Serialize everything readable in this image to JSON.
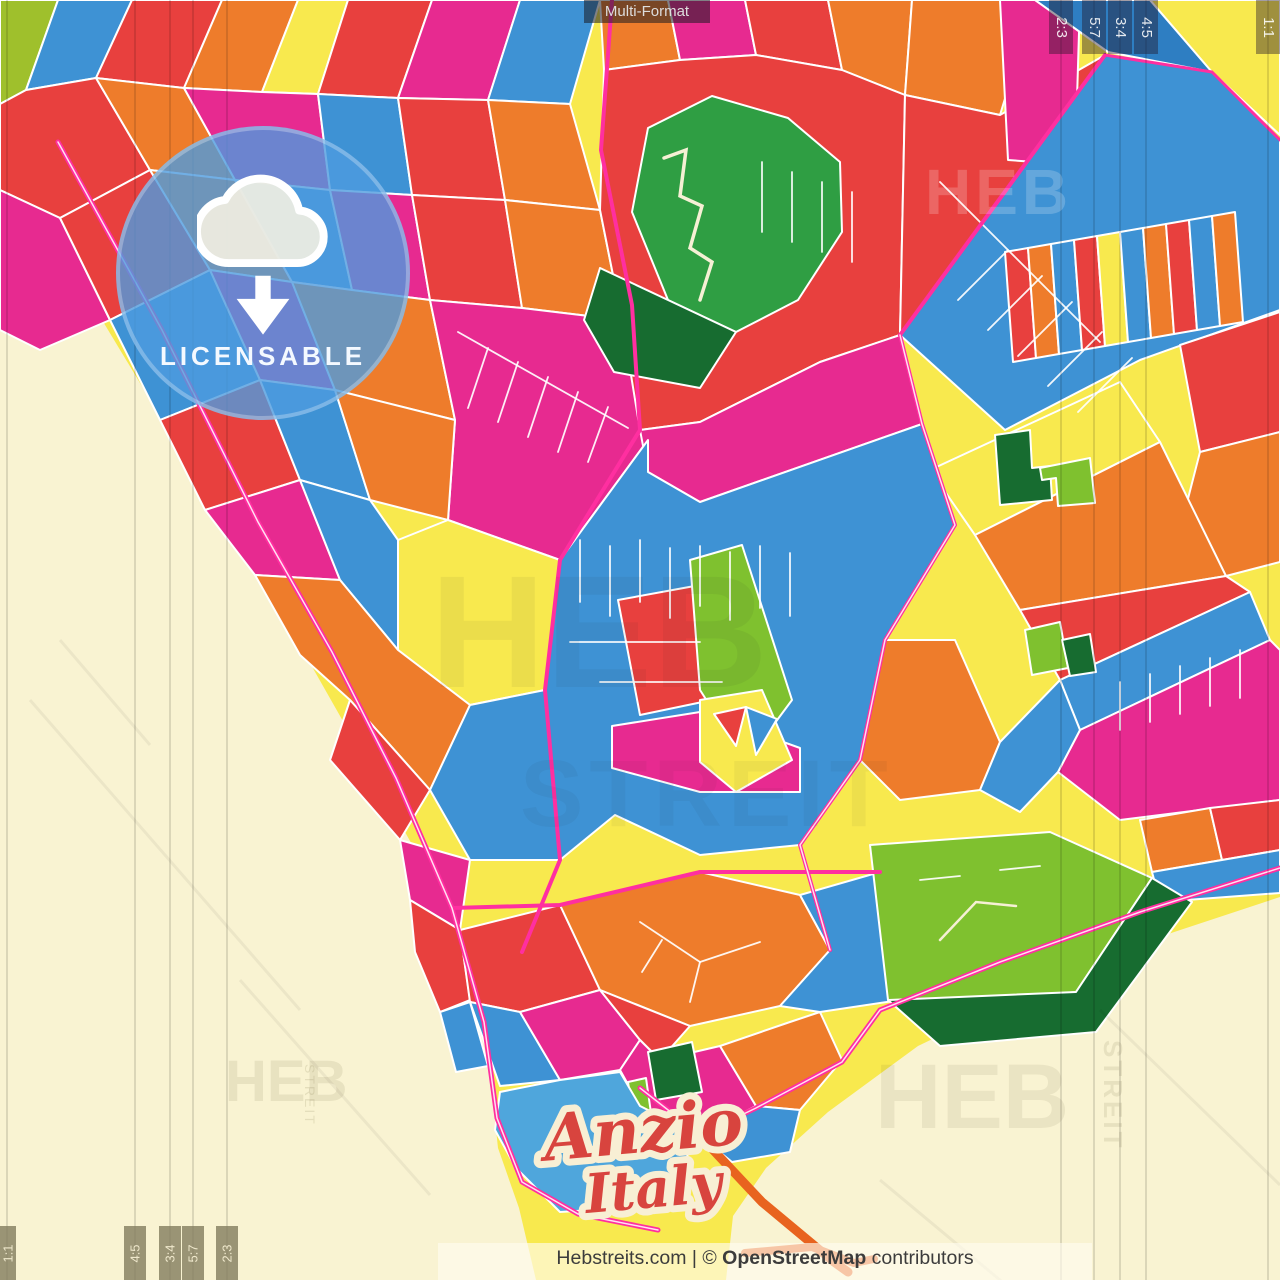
{
  "overlay": {
    "format_tag": "Multi-Format",
    "badge": {
      "label": "LICENSABLE"
    },
    "city_label": {
      "line1": "Anzio",
      "line2": "Italy"
    },
    "footer": {
      "prefix": "Hebstreits.com | © ",
      "brand": "OpenStreetMap",
      "suffix": " contributors"
    },
    "format_marks": {
      "top": [
        "2:3",
        "5:7",
        "3:4",
        "4:5",
        "1:1"
      ],
      "bottom_left": [
        "1:1",
        "4:5",
        "3:4",
        "5:7",
        "2:3"
      ]
    },
    "watermark": {
      "word": "HEB",
      "word2": "STREIT"
    }
  },
  "palette": {
    "sea": "#F9F3D2",
    "coast_sand": "#F8E94E",
    "red": "#E8403E",
    "magenta": "#E72A90",
    "orange": "#EE7C2B",
    "blue": "#3E92D4",
    "light_blue": "#4FA6DC",
    "green": "#2F9E43",
    "dark_green": "#176C30",
    "lime": "#7FC12F",
    "olive": "#9FC02C",
    "road_pink": "#FF2FA0",
    "pier_orange": "#E8631F",
    "badge_blue": "#4D9EE4",
    "title_red": "#D8443E"
  }
}
